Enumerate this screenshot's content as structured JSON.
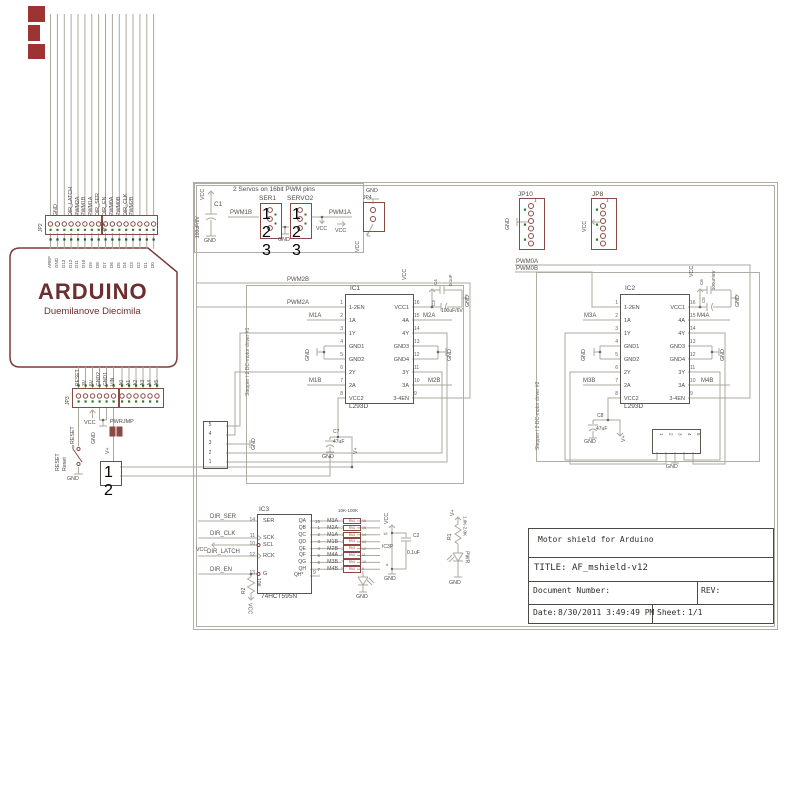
{
  "colors": {
    "component": "#8a4a44",
    "wire": "#ada89f",
    "green_dot": "#2c7a2c",
    "title_red": "#6b2f2f"
  },
  "arduino": {
    "title": "ARDUINO",
    "subtitle": "Duemilanove  Diecimila",
    "jp2": "JP2",
    "jp1": "JP1",
    "jp3": "JP3",
    "gnd_signal": "GND",
    "digital_signals": [
      "DIR_LATCH",
      "PWM2A",
      "PWM1B",
      "PWM1A",
      "DIR_SER",
      "DIR_EN",
      "PWM0A",
      "PWM0B",
      "DIR_CLK",
      "PWM2B"
    ],
    "digital_pins": [
      "AREF",
      "GND",
      "D13",
      "D12",
      "D11",
      "D10",
      "D9",
      "D8",
      "D7",
      "D6",
      "D5",
      "D4",
      "D3",
      "D2",
      "D1",
      "D0"
    ],
    "power_pins": [
      "RESET",
      "3V",
      "5V",
      "GND2",
      "GND1",
      "VIN"
    ],
    "analog_pins": [
      "A0",
      "A1",
      "A2",
      "A3",
      "A4",
      "A5"
    ]
  },
  "reset_area": {
    "reset_net": "RESET",
    "vcc": "VCC",
    "gnd": "GND",
    "pwrjmp": "PWRJMP",
    "vplus": "V+",
    "button_ref": "RESET",
    "button_name": "Reset",
    "button_gnd": "GND",
    "terminal_pins": [
      "1",
      "2"
    ]
  },
  "servo": {
    "caption": "2 Servos on 16bit PWM pins",
    "c1_ref": "C1",
    "c1_value": "100uF/6V",
    "vcc_top": "VCC",
    "gnd_bot": "GND",
    "ser1": "SER1",
    "servo2": "SERVO2",
    "pins": [
      "1",
      "2",
      "3"
    ],
    "pwm1b": "PWM1B",
    "pwm1a": "PWM1A",
    "gnd_mid": "GND",
    "vcc_mid": "VCC",
    "vcc_right": "VCC"
  },
  "jp4": {
    "ref": "JP4",
    "gnd": "GND",
    "vcc": "VCC"
  },
  "jp10": {
    "ref": "JP10",
    "pin1": "1",
    "gnd": "GND"
  },
  "jp8": {
    "ref": "JP8",
    "pin1": "1",
    "vcc": "VCC"
  },
  "driver1": {
    "frame_label": "Stepper / 2 DC-motor driver #1",
    "ic_ref": "IC1",
    "ic_part": "L293D",
    "left_pins": [
      {
        "num": "1",
        "name": "1-2EN"
      },
      {
        "num": "2",
        "name": "1A"
      },
      {
        "num": "3",
        "name": "1Y"
      },
      {
        "num": "4",
        "name": "GND1"
      },
      {
        "num": "5",
        "name": "GND2"
      },
      {
        "num": "6",
        "name": "2Y"
      },
      {
        "num": "7",
        "name": "2A"
      },
      {
        "num": "8",
        "name": "VCC2"
      }
    ],
    "right_pins": [
      {
        "num": "16",
        "name": "VCC1"
      },
      {
        "num": "15",
        "name": "4A"
      },
      {
        "num": "14",
        "name": "4Y"
      },
      {
        "num": "13",
        "name": "GND3"
      },
      {
        "num": "12",
        "name": "GND4"
      },
      {
        "num": "11",
        "name": "3Y"
      },
      {
        "num": "10",
        "name": "3A"
      },
      {
        "num": "9",
        "name": "3-4EN"
      }
    ],
    "pwm2b": "PWM2B",
    "pwm2a": "PWM2A",
    "m1a": "M1A",
    "m1b": "M1B",
    "m2a": "M2A",
    "m2b": "M2B",
    "vcc": "VCC",
    "gnd": "GND",
    "c4_ref": "C4",
    "c4_value": "0.1uF",
    "c3_ref": "C3",
    "c3_value": "100uF/6V",
    "c7_ref": "C7",
    "c7_value": "47uF",
    "vplus": "V+",
    "terminal_pins": [
      "5",
      "4",
      "3",
      "2",
      "1"
    ]
  },
  "driver2": {
    "frame_label": "Stepper / 2 DC-motor driver #2",
    "ic_ref": "IC2",
    "ic_part": "L293D",
    "pwm0a": "PWM0A",
    "pwm0b": "PWM0B",
    "m3a": "M3A",
    "m3b": "M3B",
    "m4a": "M4A",
    "m4b": "M4B",
    "vcc": "VCC",
    "gnd": "GND",
    "c6_ref": "C6",
    "c5_ref": "C5",
    "c5_value": "100uF/6V",
    "c8_ref": "C8",
    "c8_value": "47uF",
    "vplus": "V+",
    "terminal_pins": [
      "1",
      "2",
      "3",
      "4",
      "5"
    ]
  },
  "logic": {
    "ic_ref": "IC3",
    "ic_part": "74HCT595N",
    "left_pins": [
      {
        "num": "14",
        "name": "SER"
      },
      {
        "num": "11",
        "name": "SCK"
      },
      {
        "num": "10",
        "name": "SCL"
      },
      {
        "num": "12",
        "name": "RCK"
      },
      {
        "num": "13",
        "name": "G"
      }
    ],
    "out_names": [
      "QA",
      "QB",
      "QC",
      "QD",
      "QE",
      "QF",
      "QG",
      "QH"
    ],
    "qh2_name": "QH*",
    "qh2_num": "9",
    "dir_ser": "DIR_SER",
    "dir_clk": "DIR_CLK",
    "dir_latch": "DIR_LATCH",
    "dir_en": "DIR_EN",
    "vcc_left": "VCC",
    "rn_title": "10K-100K",
    "rn_ref": "RN1",
    "rn_rows": [
      {
        "num": "15",
        "net": "M3A",
        "l": "1",
        "r": "16"
      },
      {
        "num": "1",
        "net": "M2A",
        "l": "2",
        "r": "15"
      },
      {
        "num": "2",
        "net": "M1A",
        "l": "3",
        "r": "14"
      },
      {
        "num": "3",
        "net": "M1B",
        "l": "4",
        "r": "13"
      },
      {
        "num": "4",
        "net": "M2B",
        "l": "5",
        "r": "12"
      },
      {
        "num": "5",
        "net": "M4A",
        "l": "6",
        "r": "11"
      },
      {
        "num": "6",
        "net": "M3B",
        "l": "7",
        "r": "10"
      },
      {
        "num": "7",
        "net": "M4B",
        "l": "8",
        "r": "9"
      }
    ],
    "r2_ref": "R2",
    "r2_value": "10K",
    "r2_vcc": "VCC",
    "led_gnd": "GND",
    "ic3p_ref": "IC3P",
    "ic3p_pin_top": "16",
    "ic3p_pin_bot": "8",
    "ic3p_vcc": "VCC",
    "ic3p_gnd": "GND",
    "c2_ref": "C2",
    "c2_value": "0.1uF"
  },
  "pwr_led": {
    "vplus": "V+",
    "r1_ref": "R1",
    "r1_value": "1.0K-2.0K",
    "led_label": "PWR",
    "gnd": "GND"
  },
  "title_block": {
    "project": "Motor shield for Arduino",
    "title_label": "TITLE:",
    "title": "AF_mshield-v12",
    "doc_label": "Document Number:",
    "rev_label": "REV:",
    "date_label": "Date:",
    "date": "8/30/2011 3:49:49 PM",
    "sheet_label": "Sheet:",
    "sheet": "1/1"
  }
}
